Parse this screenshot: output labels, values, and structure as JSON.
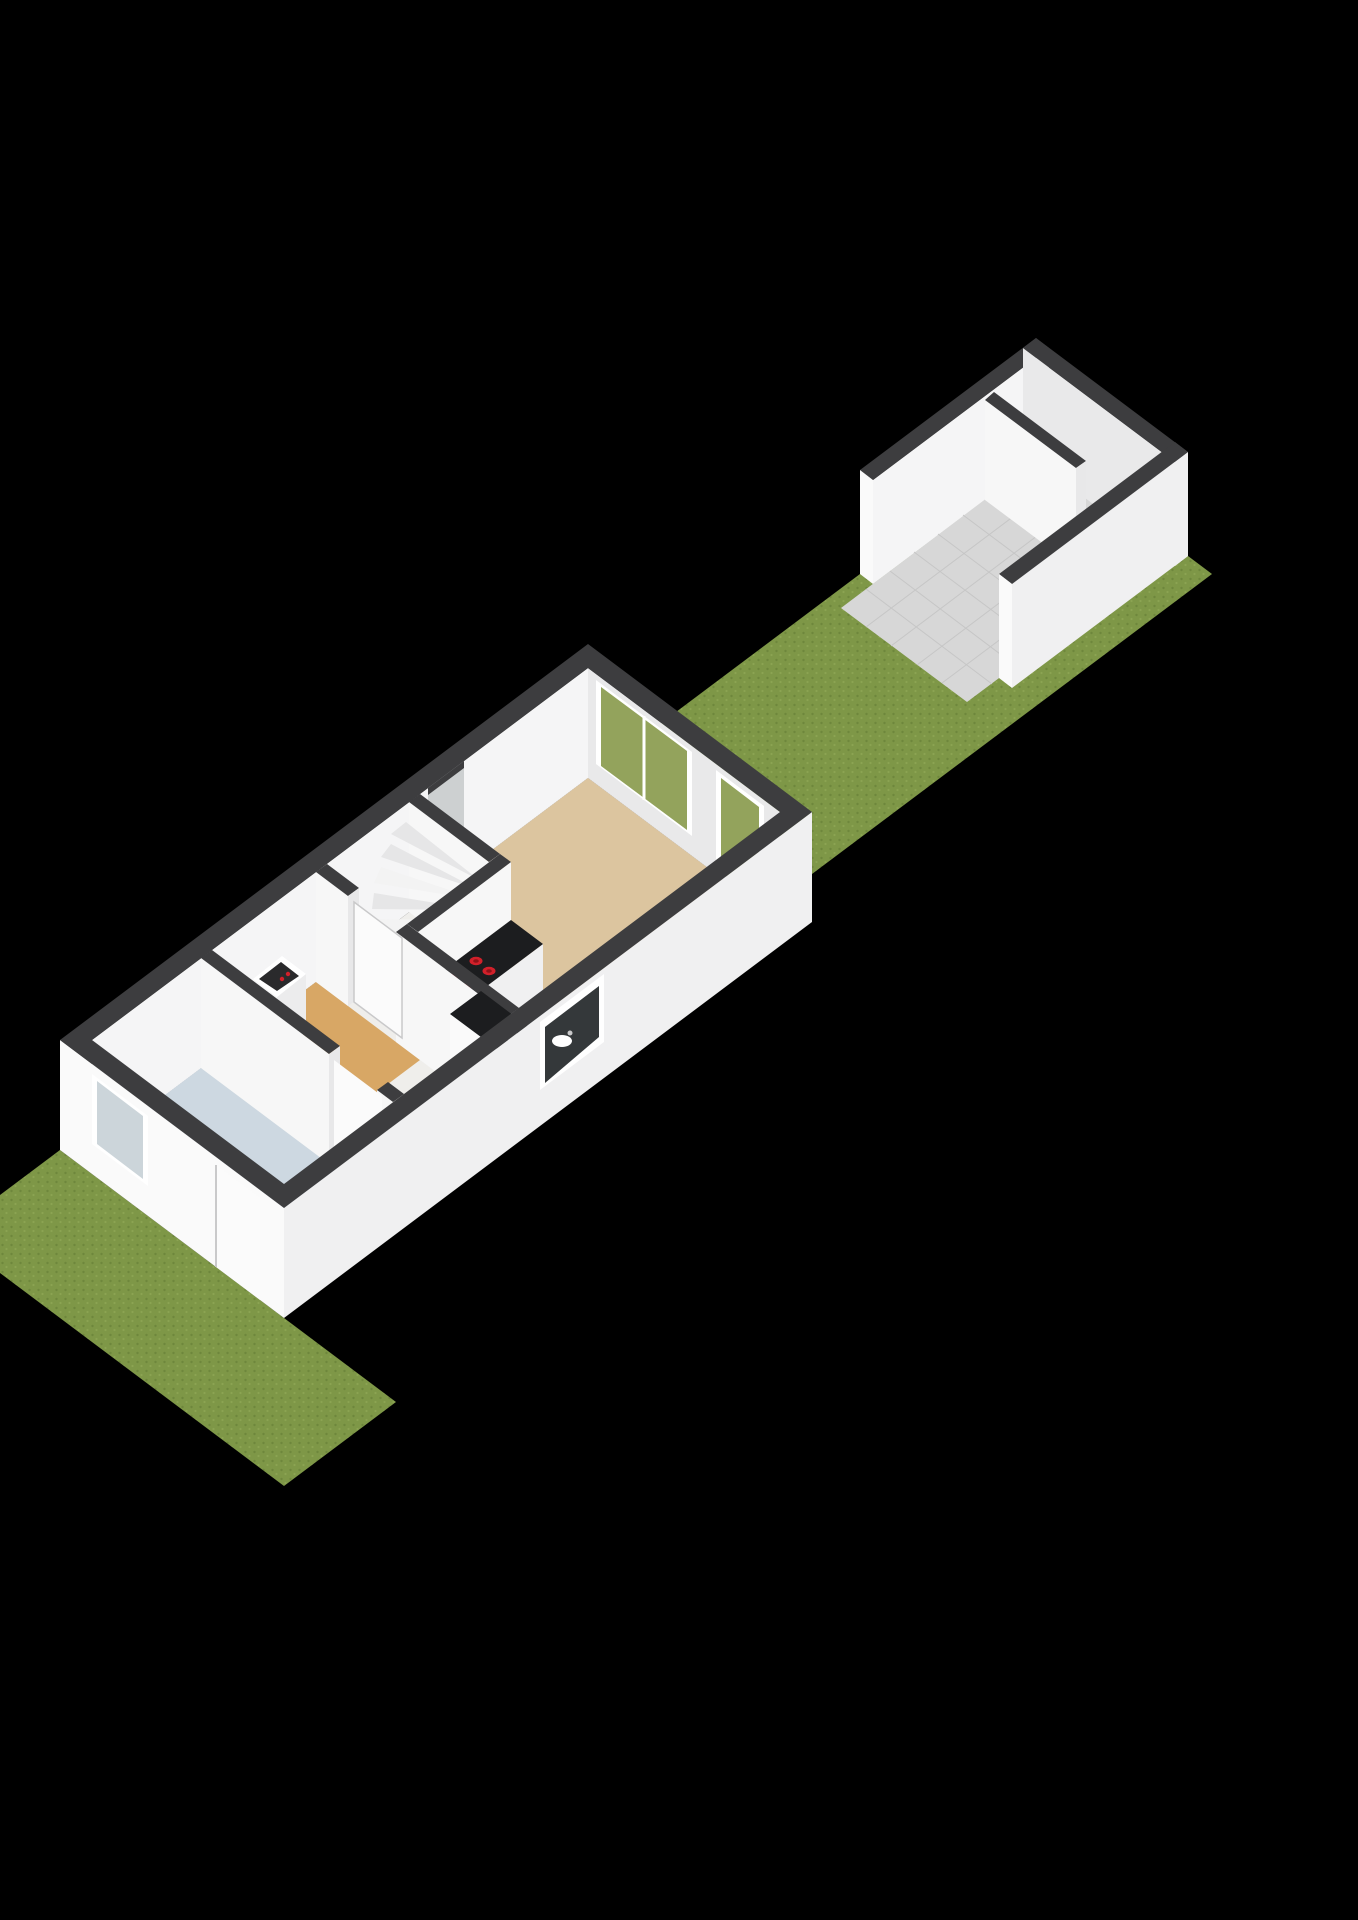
{
  "scene": {
    "type": "isometric-3d-floorplan-render",
    "view": "ground-floor-with-gardens-and-outbuilding",
    "rooms": [
      {
        "name": "living-room",
        "floor_finish": "beige"
      },
      {
        "name": "kitchen",
        "floor_finish": "light-blue",
        "fixtures": [
          "l-shaped-black-counter",
          "cooktop",
          "sink"
        ]
      },
      {
        "name": "hallway",
        "floor_finish": "wood-tan"
      },
      {
        "name": "bathroom",
        "floor_finish": "light-blue"
      },
      {
        "name": "stairwell",
        "fixture": "winder-staircase",
        "tread_count": 8
      }
    ],
    "outbuilding": {
      "name": "garden-storage",
      "floor_finish": "gray-tiles",
      "has_partition_wall": true,
      "open_front": true
    },
    "gardens": [
      {
        "name": "front-garden",
        "surface": "grass"
      },
      {
        "name": "back-garden",
        "surface": "grass"
      }
    ],
    "windows": [
      "back-wall-large-window",
      "back-wall-glass-door",
      "kitchen-window",
      "bathroom-front-window"
    ],
    "doors": [
      "front-door",
      "bathroom-door",
      "stairwell-door"
    ],
    "fixtures": {
      "cooktop_burners": 4,
      "boiler_indicator_dots": 2
    }
  },
  "colors": {
    "background": "#000000",
    "grassBase": "#7e9747",
    "grassDark": "#6e873c",
    "grassLight": "#8ba452",
    "wallTop": "#3d3d3f",
    "extWallSW": "#fafafa",
    "extWallSE": "#f0f0f1",
    "innerWallBright": "#f5f5f6",
    "innerWallShade": "#e9e9ea",
    "partitionFace": "#f7f7f7",
    "partitionEnd": "#e8e8e9",
    "slabFloor": "#efeeeb",
    "bathroomFloor": "#cdd8e1",
    "hallFloor": "#d8a765",
    "kitchenFloor": "#cdd8e1",
    "livingFloor": "#dcc59f",
    "garageFloor": "#d7d7d7",
    "tileLine": "#c6c6c6",
    "stepLight": "#f3f3f3",
    "stepDark": "#e6e6e7",
    "stepSide": "#e0e0e1",
    "stepRiser": "#d8d8d9",
    "counterTop": "#1c1d1f",
    "burnerRed": "#d1202a",
    "burnerCore": "#8e1218",
    "sinkWhite": "#ffffff",
    "doorLeaf": "#fbfbfb",
    "doorEdge": "#c9c9ca",
    "glassCool": "#ccd5da",
    "glassGrass": "#93a35c",
    "glassDark": "#34383a",
    "frameWhite": "#ffffff",
    "recessFace": "#cdd0d1",
    "boilerBody": "#f6f6f7",
    "boilerSide": "#ececed",
    "boilerInset": "#2a2a2c"
  }
}
